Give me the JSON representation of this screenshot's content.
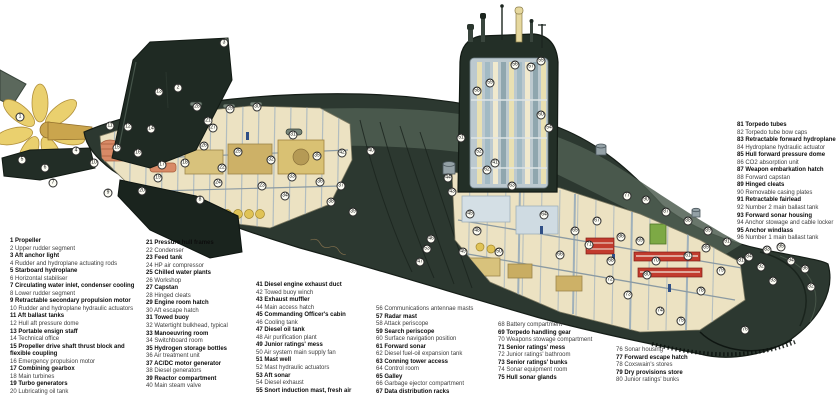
{
  "figure": {
    "type": "cutaway-diagram",
    "subject": "nuclear submarine cutaway with numbered key"
  },
  "palette": {
    "background": "#ffffff",
    "hull": "#2c3830",
    "hull_shadow": "#151d17",
    "hull_highlight": "#4f5e51",
    "fin": "#1f2a23",
    "interior_cream": "#ece2c2",
    "frame_blue": "#a9b7bf",
    "machinery_tan": "#d8c27c",
    "machinery_orange": "#d88a66",
    "bottles_yellow": "#e0c356",
    "torpedo_red": "#c23b2e",
    "cabinet_green": "#7da945",
    "sail_interior": "#bcc9cf",
    "mast_cream": "#e6d89e",
    "propeller_gold": "#ead06e",
    "label_bold": "#0d0d0d",
    "label_regular": "#3d3d3d"
  },
  "label_columns": [
    {
      "id": "key-column-1",
      "x": 10,
      "y": 238,
      "width": 134,
      "wrap": true,
      "items": [
        {
          "n": 1,
          "text": "Propeller"
        },
        {
          "n": 2,
          "text": "Upper rudder segment"
        },
        {
          "n": 3,
          "text": "Aft anchor light"
        },
        {
          "n": 4,
          "text": "Rudder and hydroplane actuating rods"
        },
        {
          "n": 5,
          "text": "Starboard hydroplane"
        },
        {
          "n": 6,
          "text": "Horizontal stabiliser"
        },
        {
          "n": 7,
          "text": "Circulating water inlet, condenser cooling"
        },
        {
          "n": 8,
          "text": "Lower rudder segment"
        },
        {
          "n": 9,
          "text": "Retractable secondary propulsion motor"
        },
        {
          "n": 10,
          "text": "Rudder and hydroplane hydraulic actuators"
        },
        {
          "n": 11,
          "text": "Aft ballast tanks"
        },
        {
          "n": 12,
          "text": "Hull aft pressure dome"
        },
        {
          "n": 13,
          "text": "Portable ensign staff"
        },
        {
          "n": 14,
          "text": "Technical office"
        },
        {
          "n": 15,
          "text": "Propeller drive shaft thrust block and flexible coupling"
        },
        {
          "n": 16,
          "text": "Emergency propulsion motor"
        },
        {
          "n": 17,
          "text": "Combining gearbox"
        },
        {
          "n": 18,
          "text": "Main turbines"
        },
        {
          "n": 19,
          "text": "Turbo generators"
        },
        {
          "n": 20,
          "text": "Lubricating oil tank"
        }
      ]
    },
    {
      "id": "key-column-2",
      "x": 146,
      "y": 240,
      "width": 112,
      "wrap": false,
      "items": [
        {
          "n": 21,
          "text": "Pressure hull frames"
        },
        {
          "n": 22,
          "text": "Condenser"
        },
        {
          "n": 23,
          "text": "Feed tank"
        },
        {
          "n": 24,
          "text": "HP air compressor"
        },
        {
          "n": 25,
          "text": "Chilled water plants"
        },
        {
          "n": 26,
          "text": "Workshop"
        },
        {
          "n": 27,
          "text": "Capstan"
        },
        {
          "n": 28,
          "text": "Hinged cleats"
        },
        {
          "n": 29,
          "text": "Engine room hatch"
        },
        {
          "n": 30,
          "text": "Aft escape hatch"
        },
        {
          "n": 31,
          "text": "Towed buoy"
        },
        {
          "n": 32,
          "text": "Watertight bulkhead, typical"
        },
        {
          "n": 33,
          "text": "Manoeuvring room"
        },
        {
          "n": 34,
          "text": "Switchboard room"
        },
        {
          "n": 35,
          "text": "Hydrogen storage bottles"
        },
        {
          "n": 36,
          "text": "Air treatment unit"
        },
        {
          "n": 37,
          "text": "AC/DC motor generator"
        },
        {
          "n": 38,
          "text": "Diesel generators"
        },
        {
          "n": 39,
          "text": "Reactor compartment"
        },
        {
          "n": 40,
          "text": "Main steam valve"
        }
      ]
    },
    {
      "id": "key-column-3",
      "x": 256,
      "y": 282,
      "width": 120,
      "wrap": false,
      "items": [
        {
          "n": 41,
          "text": "Diesel engine exhaust duct"
        },
        {
          "n": 42,
          "text": "Towed buoy winch"
        },
        {
          "n": 43,
          "text": "Exhaust muffler"
        },
        {
          "n": 44,
          "text": "Main access hatch"
        },
        {
          "n": 45,
          "text": "Commanding Officer's cabin"
        },
        {
          "n": 46,
          "text": "Cooling tank"
        },
        {
          "n": 47,
          "text": "Diesel oil tank"
        },
        {
          "n": 48,
          "text": "Air purification plant"
        },
        {
          "n": 49,
          "text": "Junior ratings' mess"
        },
        {
          "n": 50,
          "text": "Air system main supply fan"
        },
        {
          "n": 51,
          "text": "Mast well"
        },
        {
          "n": 52,
          "text": "Mast hydraulic actuators"
        },
        {
          "n": 53,
          "text": "Aft sonar"
        },
        {
          "n": 54,
          "text": "Diesel exhaust"
        },
        {
          "n": 55,
          "text": "Snort induction mast, fresh air"
        }
      ]
    },
    {
      "id": "key-column-4",
      "x": 376,
      "y": 306,
      "width": 122,
      "wrap": false,
      "items": [
        {
          "n": 56,
          "text": "Communications antennae masts"
        },
        {
          "n": 57,
          "text": "Radar mast"
        },
        {
          "n": 58,
          "text": "Attack periscope"
        },
        {
          "n": 59,
          "text": "Search periscope"
        },
        {
          "n": 60,
          "text": "Surface navigation position"
        },
        {
          "n": 61,
          "text": "Forward sonar"
        },
        {
          "n": 62,
          "text": "Diesel fuel-oil expansion tank"
        },
        {
          "n": 63,
          "text": "Conning tower access"
        },
        {
          "n": 64,
          "text": "Control room"
        },
        {
          "n": 65,
          "text": "Galley"
        },
        {
          "n": 66,
          "text": "Garbage ejector compartment"
        },
        {
          "n": 67,
          "text": "Data distribution racks"
        }
      ]
    },
    {
      "id": "key-column-5",
      "x": 498,
      "y": 322,
      "width": 118,
      "wrap": false,
      "items": [
        {
          "n": 68,
          "text": "Battery compartment"
        },
        {
          "n": 69,
          "text": "Torpedo handling gear"
        },
        {
          "n": 70,
          "text": "Weapons stowage compartment"
        },
        {
          "n": 71,
          "text": "Senior ratings' mess"
        },
        {
          "n": 72,
          "text": "Junior ratings' bathroom"
        },
        {
          "n": 73,
          "text": "Senior ratings' bunks"
        },
        {
          "n": 74,
          "text": "Sonar equipment room"
        },
        {
          "n": 75,
          "text": "Hull sonar glands"
        }
      ]
    },
    {
      "id": "key-column-6",
      "x": 616,
      "y": 347,
      "width": 112,
      "wrap": false,
      "items": [
        {
          "n": 76,
          "text": "Sonar housing"
        },
        {
          "n": 77,
          "text": "Forward escape hatch"
        },
        {
          "n": 78,
          "text": "Coxswain's stores"
        },
        {
          "n": 79,
          "text": "Dry provisions store"
        },
        {
          "n": 80,
          "text": "Junior ratings' bunks"
        }
      ]
    },
    {
      "id": "key-column-7",
      "x": 737,
      "y": 122,
      "width": 102,
      "wrap": false,
      "items": [
        {
          "n": 81,
          "text": "Torpedo tubes"
        },
        {
          "n": 82,
          "text": "Torpedo tube bow caps"
        },
        {
          "n": 83,
          "text": "Retractable forward hydroplane"
        },
        {
          "n": 84,
          "text": "Hydroplane hydraulic actuator"
        },
        {
          "n": 85,
          "text": "Hull forward pressure dome"
        },
        {
          "n": 86,
          "text": "CO2 absorption unit"
        },
        {
          "n": 87,
          "text": "Weapon embarkation hatch"
        },
        {
          "n": 88,
          "text": "Forward capstan"
        },
        {
          "n": 89,
          "text": "Hinged cleats"
        },
        {
          "n": 90,
          "text": "Removable casing plates"
        },
        {
          "n": 91,
          "text": "Retractable fairlead"
        },
        {
          "n": 92,
          "text": "Number 2 main ballast tank"
        },
        {
          "n": 93,
          "text": "Forward sonar housing"
        },
        {
          "n": 94,
          "text": "Anchor stowage and cable locker"
        },
        {
          "n": 95,
          "text": "Anchor windlass"
        },
        {
          "n": 96,
          "text": "Number 1 main ballast tank"
        }
      ]
    }
  ],
  "callouts": [
    {
      "n": 1,
      "x": 20,
      "y": 117
    },
    {
      "n": 2,
      "x": 178,
      "y": 88
    },
    {
      "n": 3,
      "x": 224,
      "y": 43
    },
    {
      "n": 4,
      "x": 76,
      "y": 151
    },
    {
      "n": 5,
      "x": 22,
      "y": 160
    },
    {
      "n": 6,
      "x": 45,
      "y": 168
    },
    {
      "n": 7,
      "x": 53,
      "y": 183
    },
    {
      "n": 8,
      "x": 200,
      "y": 200
    },
    {
      "n": 9,
      "x": 108,
      "y": 193
    },
    {
      "n": 10,
      "x": 94,
      "y": 163
    },
    {
      "n": 11,
      "x": 110,
      "y": 126
    },
    {
      "n": 12,
      "x": 128,
      "y": 127
    },
    {
      "n": 13,
      "x": 159,
      "y": 92
    },
    {
      "n": 14,
      "x": 151,
      "y": 129
    },
    {
      "n": 15,
      "x": 117,
      "y": 148
    },
    {
      "n": 16,
      "x": 138,
      "y": 153
    },
    {
      "n": 17,
      "x": 162,
      "y": 165
    },
    {
      "n": 18,
      "x": 185,
      "y": 163
    },
    {
      "n": 19,
      "x": 158,
      "y": 178
    },
    {
      "n": 20,
      "x": 142,
      "y": 191
    },
    {
      "n": 21,
      "x": 208,
      "y": 121
    },
    {
      "n": 22,
      "x": 222,
      "y": 168
    },
    {
      "n": 23,
      "x": 262,
      "y": 186
    },
    {
      "n": 24,
      "x": 218,
      "y": 183
    },
    {
      "n": 25,
      "x": 238,
      "y": 152
    },
    {
      "n": 26,
      "x": 204,
      "y": 146
    },
    {
      "n": 27,
      "x": 213,
      "y": 128
    },
    {
      "n": 28,
      "x": 197,
      "y": 107
    },
    {
      "n": 29,
      "x": 230,
      "y": 109
    },
    {
      "n": 30,
      "x": 257,
      "y": 107
    },
    {
      "n": 31,
      "x": 293,
      "y": 135
    },
    {
      "n": 32,
      "x": 271,
      "y": 160
    },
    {
      "n": 33,
      "x": 292,
      "y": 177
    },
    {
      "n": 34,
      "x": 285,
      "y": 196
    },
    {
      "n": 35,
      "x": 317,
      "y": 156
    },
    {
      "n": 36,
      "x": 320,
      "y": 182
    },
    {
      "n": 37,
      "x": 341,
      "y": 186
    },
    {
      "n": 38,
      "x": 331,
      "y": 202
    },
    {
      "n": 39,
      "x": 353,
      "y": 212
    },
    {
      "n": 40,
      "x": 371,
      "y": 151
    },
    {
      "n": 41,
      "x": 495,
      "y": 163
    },
    {
      "n": 42,
      "x": 342,
      "y": 153
    },
    {
      "n": 43,
      "x": 452,
      "y": 192
    },
    {
      "n": 44,
      "x": 448,
      "y": 178
    },
    {
      "n": 45,
      "x": 470,
      "y": 214
    },
    {
      "n": 46,
      "x": 431,
      "y": 239
    },
    {
      "n": 47,
      "x": 420,
      "y": 262
    },
    {
      "n": 48,
      "x": 477,
      "y": 231
    },
    {
      "n": 49,
      "x": 463,
      "y": 252
    },
    {
      "n": 50,
      "x": 499,
      "y": 252
    },
    {
      "n": 51,
      "x": 461,
      "y": 138
    },
    {
      "n": 52,
      "x": 479,
      "y": 152
    },
    {
      "n": 53,
      "x": 427,
      "y": 249
    },
    {
      "n": 54,
      "x": 549,
      "y": 128
    },
    {
      "n": 55,
      "x": 541,
      "y": 61
    },
    {
      "n": 56,
      "x": 515,
      "y": 65
    },
    {
      "n": 57,
      "x": 531,
      "y": 67
    },
    {
      "n": 58,
      "x": 477,
      "y": 91
    },
    {
      "n": 59,
      "x": 490,
      "y": 83
    },
    {
      "n": 60,
      "x": 541,
      "y": 115
    },
    {
      "n": 61,
      "x": 688,
      "y": 256
    },
    {
      "n": 62,
      "x": 487,
      "y": 170
    },
    {
      "n": 63,
      "x": 512,
      "y": 186
    },
    {
      "n": 64,
      "x": 544,
      "y": 215
    },
    {
      "n": 65,
      "x": 575,
      "y": 231
    },
    {
      "n": 66,
      "x": 560,
      "y": 255
    },
    {
      "n": 67,
      "x": 597,
      "y": 221
    },
    {
      "n": 68,
      "x": 611,
      "y": 261
    },
    {
      "n": 69,
      "x": 640,
      "y": 241
    },
    {
      "n": 70,
      "x": 656,
      "y": 261
    },
    {
      "n": 71,
      "x": 589,
      "y": 245
    },
    {
      "n": 72,
      "x": 610,
      "y": 280
    },
    {
      "n": 73,
      "x": 628,
      "y": 295
    },
    {
      "n": 74,
      "x": 660,
      "y": 311
    },
    {
      "n": 75,
      "x": 681,
      "y": 321
    },
    {
      "n": 76,
      "x": 745,
      "y": 330
    },
    {
      "n": 77,
      "x": 627,
      "y": 196
    },
    {
      "n": 78,
      "x": 701,
      "y": 291
    },
    {
      "n": 79,
      "x": 721,
      "y": 271
    },
    {
      "n": 80,
      "x": 647,
      "y": 275
    },
    {
      "n": 81,
      "x": 741,
      "y": 261
    },
    {
      "n": 82,
      "x": 811,
      "y": 287
    },
    {
      "n": 83,
      "x": 767,
      "y": 250
    },
    {
      "n": 84,
      "x": 749,
      "y": 257
    },
    {
      "n": 85,
      "x": 706,
      "y": 248
    },
    {
      "n": 86,
      "x": 621,
      "y": 237
    },
    {
      "n": 87,
      "x": 666,
      "y": 212
    },
    {
      "n": 88,
      "x": 688,
      "y": 221
    },
    {
      "n": 89,
      "x": 708,
      "y": 231
    },
    {
      "n": 90,
      "x": 646,
      "y": 200
    },
    {
      "n": 91,
      "x": 727,
      "y": 242
    },
    {
      "n": 92,
      "x": 761,
      "y": 267
    },
    {
      "n": 93,
      "x": 773,
      "y": 281
    },
    {
      "n": 94,
      "x": 791,
      "y": 261
    },
    {
      "n": 95,
      "x": 781,
      "y": 247
    },
    {
      "n": 96,
      "x": 805,
      "y": 269
    }
  ]
}
